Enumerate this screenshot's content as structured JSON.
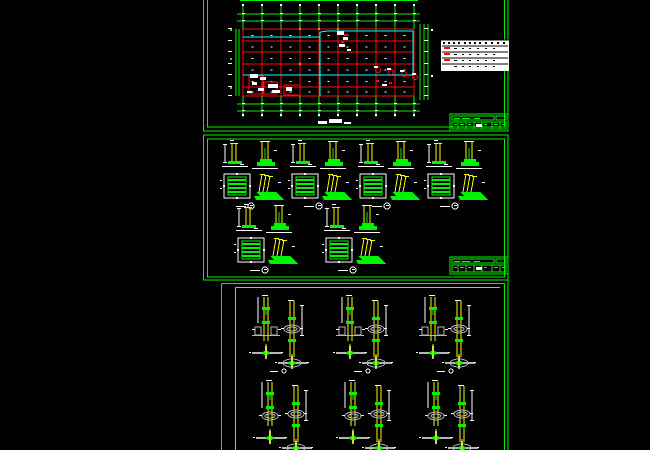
{
  "app": {
    "type": "cad-drawing-viewport",
    "background": "#000000"
  },
  "palette": {
    "green": "#00f400",
    "red": "#fa0a0a",
    "cyan": "#00ffff",
    "yellow": "#fcfc00",
    "white": "#ffffff",
    "gray": "#b4b4b4",
    "orange": "#ff8400",
    "black": "#000000"
  },
  "sheet_stack": {
    "right_edge_x": 508
  },
  "sheet1": {
    "name": "foundation-plan-sheet",
    "border_outer": [
      203.5,
      -14,
      304.5,
      145
    ],
    "border_inner": [
      207.5,
      -10,
      297,
      137
    ],
    "plan": {
      "grid_cols": [
        243,
        262,
        281,
        300,
        319,
        338,
        357,
        376,
        395,
        414
      ],
      "grid_rows": [
        29,
        41,
        52,
        64,
        75,
        87,
        96
      ],
      "top_dim_y": [
        14,
        21
      ],
      "bottom_dim_y": [
        104,
        111
      ],
      "left_dim_x": [
        236,
        239
      ],
      "right_dim_x": [
        420,
        424,
        428
      ],
      "cyan_segments": [
        [
          243,
          37,
          320,
          37
        ],
        [
          320,
          37,
          320,
          96
        ],
        [
          320,
          37,
          320,
          32
        ],
        [
          320,
          32,
          328,
          31
        ],
        [
          328,
          31,
          413,
          31
        ],
        [
          413,
          31,
          413,
          75
        ],
        [
          243,
          75,
          413,
          75
        ]
      ],
      "detail_boxes_red": [
        [
          249,
          76,
          14,
          18
        ],
        [
          264,
          82,
          13,
          12
        ],
        [
          284,
          85,
          16,
          10
        ]
      ],
      "blob_cluster_white": [
        [
          250,
          74,
          8,
          4
        ],
        [
          260,
          77,
          6,
          3
        ],
        [
          252,
          82,
          5,
          3
        ],
        [
          268,
          84,
          10,
          4
        ],
        [
          258,
          88,
          6,
          3
        ],
        [
          272,
          90,
          8,
          3
        ],
        [
          286,
          87,
          6,
          4
        ],
        [
          247,
          91,
          5,
          2
        ]
      ],
      "cluster_mid_white": [
        [
          337,
          31,
          7,
          4
        ],
        [
          343,
          37,
          5,
          3
        ],
        [
          339,
          44,
          6,
          3
        ],
        [
          347,
          49,
          4,
          2
        ]
      ],
      "cluster_mid_red": [
        [
          344,
          34,
          4,
          2
        ],
        [
          341,
          41,
          3,
          2
        ]
      ],
      "anno_circles_red": [
        [
          378,
          70
        ],
        [
          391,
          72
        ],
        [
          404,
          74
        ],
        [
          415,
          77
        ]
      ],
      "anno_dashes_white": [
        [
          374,
          66,
          4,
          2
        ],
        [
          387,
          68,
          4,
          2
        ],
        [
          400,
          70,
          4,
          2
        ],
        [
          412,
          73,
          4,
          2
        ],
        [
          382,
          84,
          5,
          2
        ]
      ],
      "anno_dashes_red": [
        [
          376,
          80,
          3,
          2
        ],
        [
          389,
          82,
          3,
          2
        ]
      ],
      "orange_nodes": [
        [
          300,
          29
        ],
        [
          319,
          29
        ],
        [
          338,
          29
        ],
        [
          300,
          64
        ],
        [
          319,
          64
        ]
      ]
    },
    "legend_table": {
      "x": 441,
      "y": 40,
      "w": 68,
      "h": 31,
      "row_lines_y": [
        46,
        52,
        58,
        64
      ],
      "header_dash_xs": [
        443,
        448,
        453,
        458,
        464,
        469,
        474,
        479,
        485,
        491,
        497,
        503
      ],
      "cell_dash_xs": [
        455,
        462,
        469,
        477,
        485,
        493
      ],
      "red_mark_rows_y": [
        47,
        53,
        59,
        65
      ]
    },
    "title_block": [
      450,
      114
    ],
    "title_smudges": [
      [
        318,
        121,
        9,
        3
      ],
      [
        329,
        119,
        13,
        4
      ],
      [
        344,
        122,
        7,
        2
      ]
    ]
  },
  "sheet2": {
    "name": "foundation-details-sheet",
    "border_outer": [
      203.5,
      135,
      304.5,
      145
    ],
    "border_inner": [
      207.5,
      139,
      297,
      138
    ],
    "groups": [
      [
        224,
        142
      ],
      [
        292,
        142
      ],
      [
        360,
        142
      ],
      [
        428,
        142
      ],
      [
        238,
        206
      ],
      [
        326,
        206
      ]
    ],
    "title_block": [
      450,
      257
    ]
  },
  "sheet3": {
    "name": "column-details-sheet",
    "green_frame": {
      "left": 221.5,
      "top": 283.5,
      "right": 504.5,
      "bottom": 450
    },
    "cyan_frame": {
      "left": 235.5,
      "top": 287.5,
      "right": 500,
      "bottom": 450
    },
    "groups": [
      {
        "x": 258,
        "y": 295,
        "rings_left": false
      },
      {
        "x": 342,
        "y": 295,
        "rings_left": false
      },
      {
        "x": 425,
        "y": 295,
        "rings_left": false
      },
      {
        "x": 262,
        "y": 380,
        "rings_left": true
      },
      {
        "x": 345,
        "y": 380,
        "rings_left": true
      },
      {
        "x": 428,
        "y": 380,
        "rings_left": true
      }
    ]
  }
}
